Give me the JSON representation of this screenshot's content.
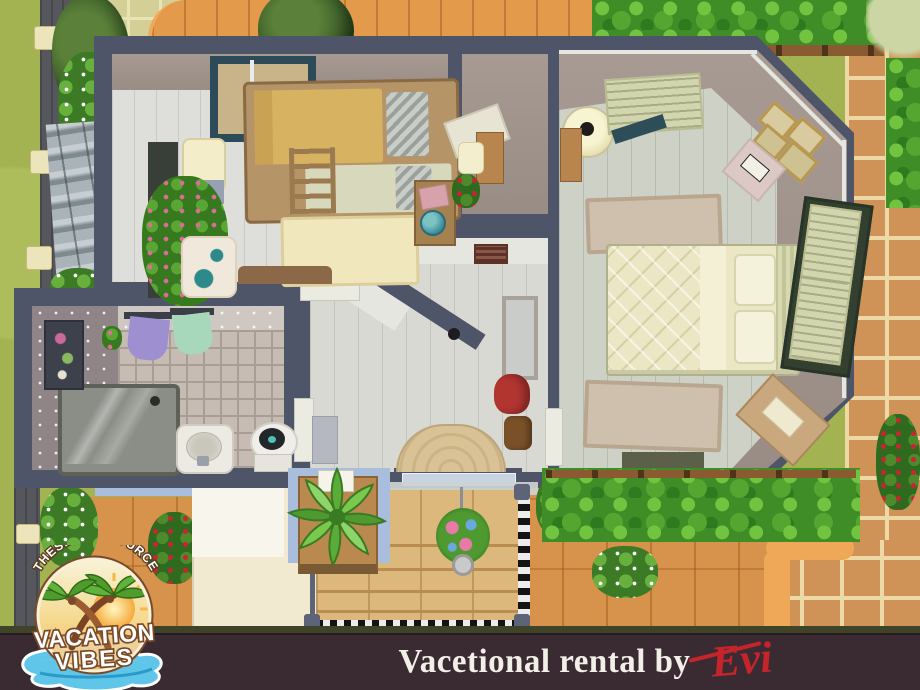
{
  "window": {
    "width": 920,
    "height": 690
  },
  "branding": {
    "logo": {
      "arc_text": "THESIMSRESOURCE",
      "line1": "VACATION",
      "line2": "VIBES"
    },
    "caption": {
      "text": "Vacetional rental by",
      "author": "Evi"
    }
  },
  "colors": {
    "house_wall": "#4e5568",
    "grass": "#a3b351",
    "hedge": "#3e8d27",
    "paving": "#cf9257",
    "deck_wood": "#e39a4b",
    "interior_wall": "#9c8f87",
    "bottom_bar": "#3a2b33",
    "caption_text": "#f2eee8",
    "signature_red": "#c5242a"
  },
  "scene": {
    "type": "sims-style-floorplan-screenshot",
    "regions": [
      "kids-bedroom",
      "master-bedroom",
      "bathroom",
      "hallway-entry",
      "entry-stairs",
      "plant-nook",
      "garden-hedges",
      "wooden-deck",
      "stone-paving",
      "awning-roof"
    ]
  }
}
